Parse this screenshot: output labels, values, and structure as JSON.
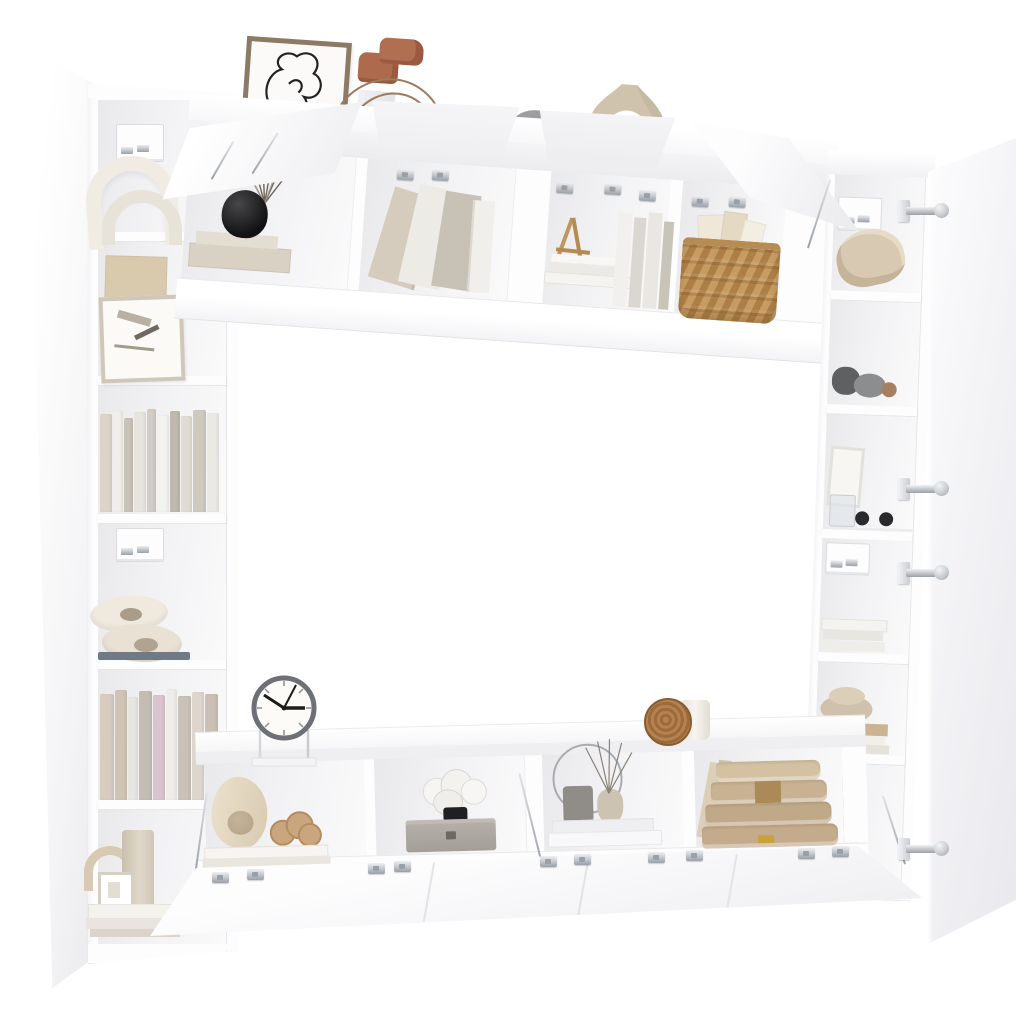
{
  "meta": {
    "type": "product-photo",
    "subject": "8-piece white wall-mounted TV cabinet / shelving set shown open with decorative props on a white background",
    "background": "#ffffff"
  },
  "palette": {
    "bg": "#ffffff",
    "panel": "#fdfdfe",
    "panelEdge": "#e6e6ea",
    "intA": "#e9e9eb",
    "intB": "#fafafb",
    "cork": "#cda171",
    "corkLight": "#d2a878",
    "corkDark": "#b3først",
    "chrome": "#c9cdd2",
    "chromeDark": "#9aa0a7",
    "black": "#1e1e20",
    "terracotta": "#ad6a4c",
    "greige": "#cfc3ad",
    "discGray": "#9d9da0",
    "wicker": "#c79c63",
    "wickerDark": "#ad7f47",
    "wood": "#b5814f",
    "ivory": "#f0ece3",
    "tanBook": "#c3ab8b",
    "tanBand": "#a8854f",
    "clockRim": "#6d7074",
    "clockFace": "#fcfbf8",
    "hand": "#1c1c1e",
    "vaseGray": "#a89d90",
    "pebble": "#cfc1ac",
    "stone": "#6f7072",
    "boxGray": "#aba69f",
    "knot": "#c9a67e",
    "vessel": "#e8ddc8",
    "reed": "#6e675c"
  },
  "scene": {
    "left_bookcase": {
      "label": "Tall narrow white bookcase with open hinged door, six compartments with cork back panels",
      "items": [
        "white arch sculptures",
        "cork pinboard",
        "leaning framed art and papers",
        "row of beige and white books",
        "stacked oval stone sculptures",
        "row of pastel books",
        "arch ornament, cylinder vase, cube lantern on stacked books",
        "wall-mount brackets"
      ]
    },
    "top_cabinets": {
      "label": "Row of four wall-mounted TV cabinets with flip-up doors open",
      "items": [
        "black reed-diffuser vase on beige boxes",
        "leaning boards and upright books",
        "wooden easel with stacked and upright books",
        "woven wicker basket with papers",
        "chrome lid stays and hinges"
      ]
    },
    "right_cabinet": {
      "label": "Tall white cabinet with side door open showing six shelves",
      "items": [
        "beige sculptural bowl",
        "gray stones and wooden ball",
        "small frame, glass and black spheres",
        "white book stack",
        "pebble bowl on wooden boards",
        "tall greige vase",
        "chrome concealed hinges"
      ]
    },
    "bottom_cabinets": {
      "label": "Row of four wall-mounted TV cabinets with flip-down doors open",
      "items": [
        "organic beige vessel and knot sculpture on books",
        "marble knot lamp on gray storage box",
        "wire ring, pots and reed sticks on white plinths",
        "stack of large tan books with leaning boards",
        "chrome hinges and stays"
      ]
    },
    "top_decor": {
      "label": "Decor standing on top of the upper cabinets",
      "items": [
        "framed abstract one-line drawing",
        "terracotta sculpture with wire loops on white pedestal",
        "gray round disc",
        "beige donut-shaped vase"
      ]
    },
    "clock": {
      "label": "Round desk clock on clear stand",
      "time_shown": "10:03"
    },
    "disc_and_cup": {
      "label": "Wooden disc and white cup on lower cabinet top"
    }
  }
}
